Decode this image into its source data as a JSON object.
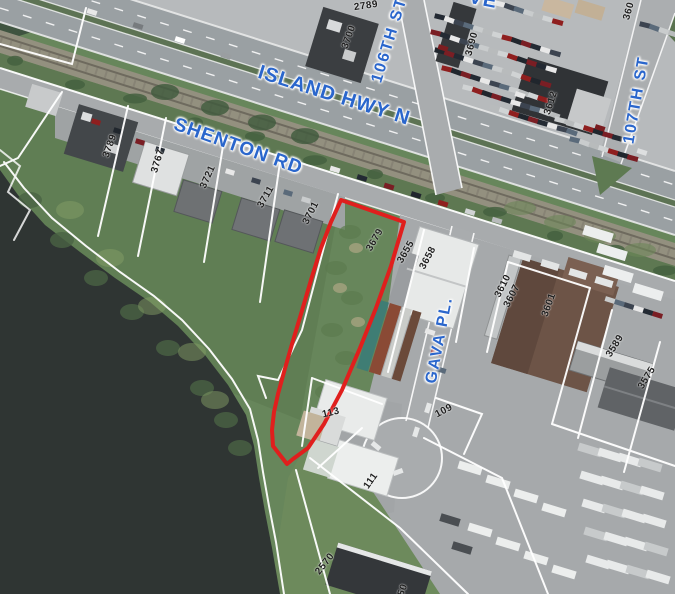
{
  "road_labels": {
    "island_hwy": "ISLAND HWY N",
    "shenton": "SHENTON RD",
    "st106": "106TH ST",
    "st107": "107TH ST",
    "gava": "GAVA PL.",
    "partial_ave": "VE"
  },
  "parcel_numbers": {
    "p2789": "2789",
    "p3700": "3700",
    "p3690": "3690",
    "p3612": "3612",
    "p360_partial": "360",
    "p3789": "3789",
    "p3767": "3767",
    "p3721": "3721",
    "p3711": "3711",
    "p3701": "3701",
    "p3679": "3679",
    "p3655": "3655",
    "p3658": "3658",
    "p3610": "3610",
    "p3607": "3607",
    "p3601": "3601",
    "p3589": "3589",
    "p3575": "3575",
    "p113": "113",
    "p109": "109",
    "p111": "111",
    "p2570": "2570",
    "p50_partial": "50"
  },
  "colors": {
    "highlight_outline": "#e01f1d",
    "road_label_blue": "#2a66cc",
    "water": "#2f3533"
  }
}
